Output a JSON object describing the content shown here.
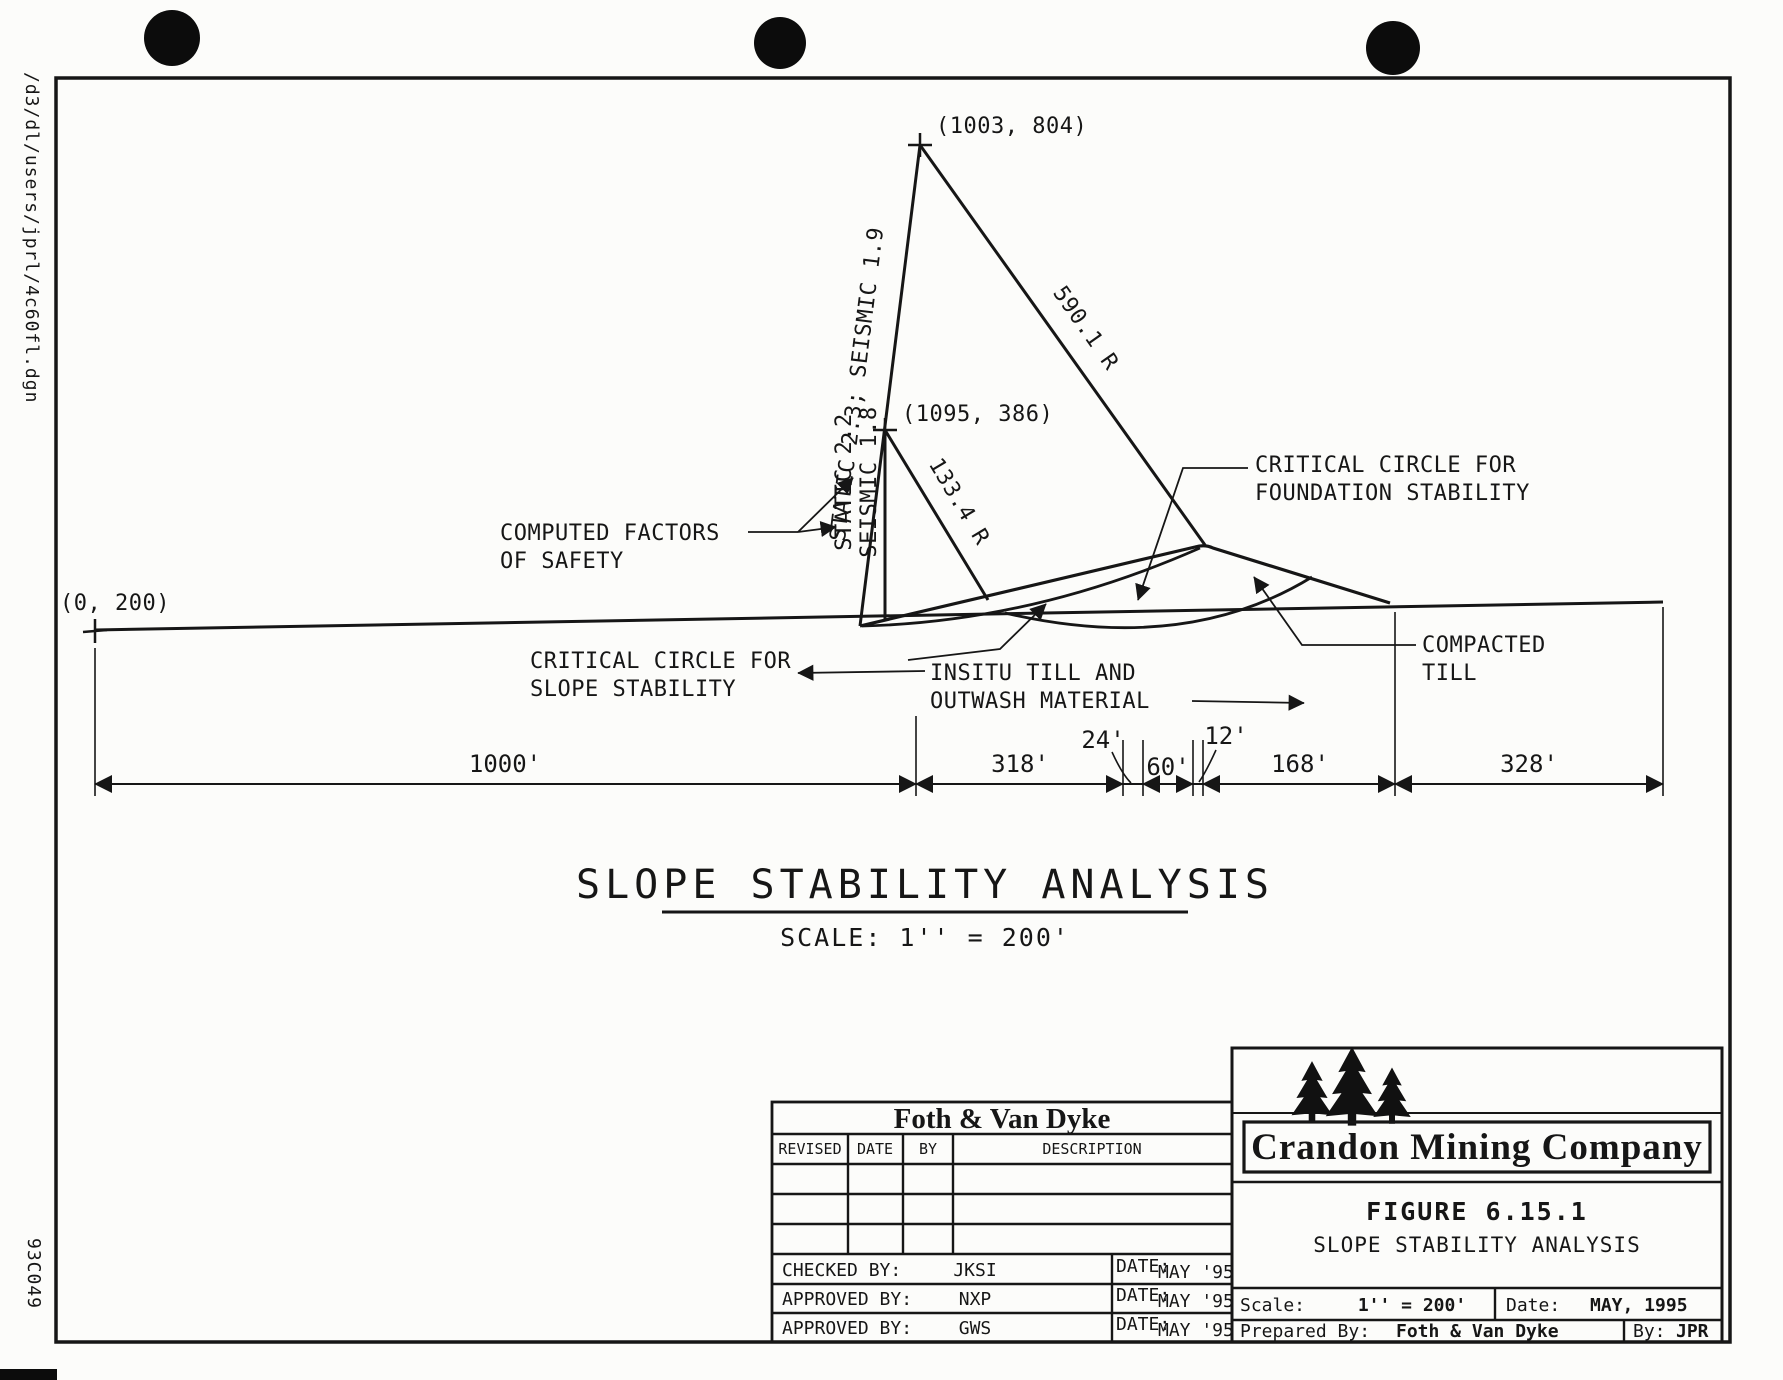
{
  "margins": {
    "file_path": "/d3/dl/users/jprl/4c60fl.dgn",
    "doc_code": "93C049"
  },
  "diagram": {
    "title": "SLOPE STABILITY ANALYSIS",
    "scale_note": "SCALE: 1'' = 200'",
    "points": {
      "apex": "(1003, 804)",
      "second": "(1095, 386)",
      "origin": "(0, 200)"
    },
    "factors": {
      "line1": "STATIC 2.3; SEISMIC 1.9",
      "static2": "STATIC 2.2",
      "seismic2": "SEISMIC 1.8"
    },
    "radii": {
      "r1": "590.1 R",
      "r2": "133.4 R"
    },
    "labels": {
      "computed1": "COMPUTED FACTORS",
      "computed2": "OF SAFETY",
      "found1": "CRITICAL CIRCLE FOR",
      "found2": "FOUNDATION STABILITY",
      "slope1": "CRITICAL CIRCLE FOR",
      "slope2": "SLOPE STABILITY",
      "insitu1": "INSITU TILL AND",
      "insitu2": "OUTWASH MATERIAL",
      "compacted1": "COMPACTED",
      "compacted2": "TILL"
    },
    "dims": [
      "1000'",
      "318'",
      "24'",
      "60'",
      "12'",
      "168'",
      "328'"
    ]
  },
  "revision_block": {
    "company": "Foth & Van Dyke",
    "headers": [
      "REVISED",
      "DATE",
      "BY",
      "DESCRIPTION"
    ],
    "signoffs": [
      {
        "label": "CHECKED BY:",
        "initials": "JKSI",
        "date_label": "DATE:",
        "date": "MAY '95"
      },
      {
        "label": "APPROVED BY:",
        "initials": "NXP",
        "date_label": "DATE:",
        "date": "MAY '95"
      },
      {
        "label": "APPROVED BY:",
        "initials": "GWS",
        "date_label": "DATE:",
        "date": "MAY '95"
      }
    ]
  },
  "title_block": {
    "company": "Crandon Mining Company",
    "figure": "FIGURE 6.15.1",
    "figure_title": "SLOPE STABILITY ANALYSIS",
    "scale_label": "Scale:",
    "scale_value": "1'' = 200'",
    "date_label": "Date:",
    "date_value": "MAY, 1995",
    "prepared_label": "Prepared By:",
    "prepared_value": "Foth & Van Dyke",
    "by_label": "By:",
    "by_value": "JPR"
  }
}
